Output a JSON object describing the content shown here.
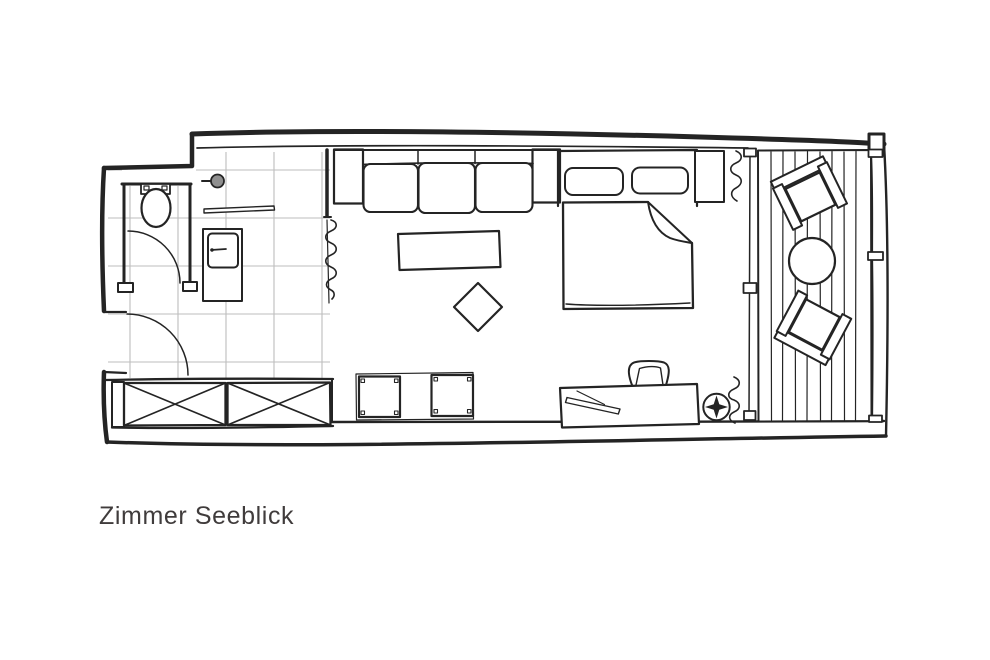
{
  "title": {
    "label": "Zimmer Seeblick"
  },
  "colors": {
    "ink": "#242424",
    "tile_line": "#bdbdbd",
    "background": "#ffffff",
    "text": "#403c3c",
    "shower_head": "#8f8f8f"
  },
  "plan": {
    "symbols": [
      "toilet",
      "wc-door",
      "entry-door",
      "shower-head",
      "shower-grab-bar",
      "vanity-cabinet",
      "tiled-floor",
      "privacy-curtain",
      "sofa",
      "coffee-table",
      "ottoman",
      "double-bed",
      "pillows",
      "blanket-fold",
      "nightstand",
      "desk",
      "desk-chair",
      "desk-accessory",
      "light-symbol",
      "bench",
      "wardrobe",
      "window-curtains",
      "sliding-glass-wall",
      "balcony-deck",
      "balcony-chair",
      "balcony-table",
      "balcony-railing"
    ]
  }
}
